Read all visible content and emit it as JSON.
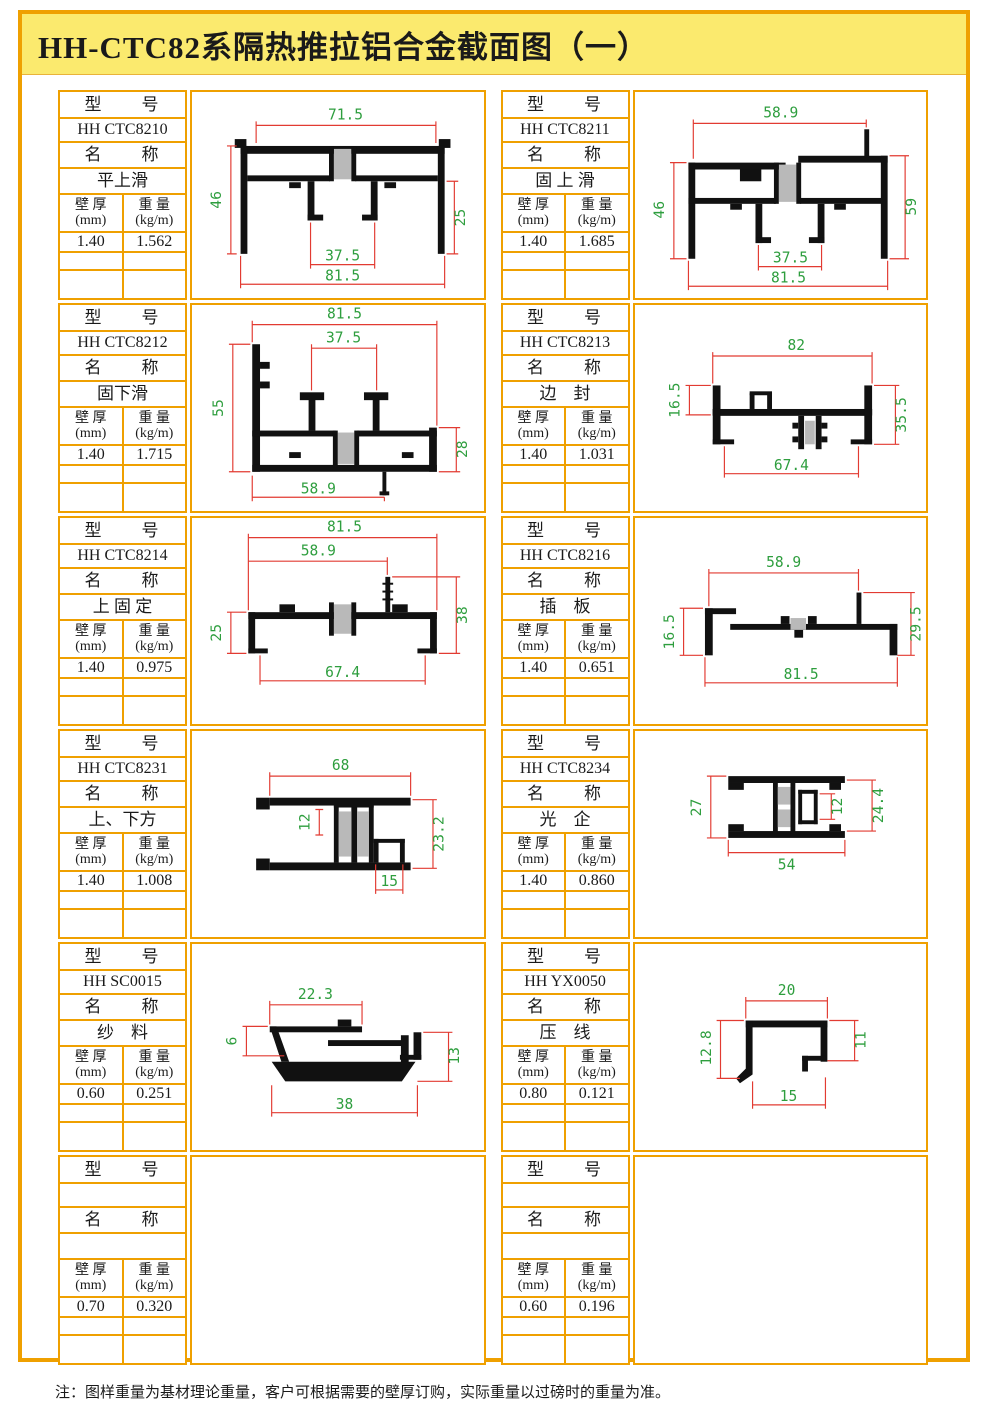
{
  "title": "HH-CTC82系隔热推拉铝合金截面图（一）",
  "note": "注：图样重量为基材理论重量，客户可根据需要的壁厚订购，实际重量以过磅时的重量为准。",
  "labels": {
    "model": "型　　号",
    "name": "名　　称",
    "thickness": "壁 厚\n(mm)",
    "weight": "重 量\n(kg/m)"
  },
  "colors": {
    "frame_border": "#efa000",
    "title_bg": "#fbea6e",
    "dim_line": "#e23b32",
    "dim_text": "#2e9e3e"
  },
  "cells": [
    {
      "model": "HH CTC8210",
      "name": "平上滑",
      "thickness": "1.40",
      "weight": "1.562",
      "dims": {
        "top": "71.5",
        "left": "46",
        "right": "25",
        "bottom1": "37.5",
        "bottom2": "81.5"
      }
    },
    {
      "model": "HH CTC8211",
      "name": "固 上 滑",
      "thickness": "1.40",
      "weight": "1.685",
      "dims": {
        "top": "58.9",
        "left": "46",
        "right": "59",
        "bottom1": "37.5",
        "bottom2": "81.5"
      }
    },
    {
      "model": "HH CTC8212",
      "name": "固下滑",
      "thickness": "1.40",
      "weight": "1.715",
      "dims": {
        "top": "81.5",
        "top2": "37.5",
        "left": "55",
        "right": "28",
        "bottom1": "58.9"
      }
    },
    {
      "model": "HH CTC8213",
      "name": "边　封",
      "thickness": "1.40",
      "weight": "1.031",
      "dims": {
        "top": "82",
        "left": "16.5",
        "right": "35.5",
        "bottom1": "67.4"
      }
    },
    {
      "model": "HH CTC8214",
      "name": "上 固 定",
      "thickness": "1.40",
      "weight": "0.975",
      "dims": {
        "top": "81.5",
        "top2": "58.9",
        "left": "25",
        "right": "38",
        "bottom1": "67.4"
      }
    },
    {
      "model": "HH CTC8216",
      "name": "插　板",
      "thickness": "1.40",
      "weight": "0.651",
      "dims": {
        "top": "58.9",
        "left": "16.5",
        "right": "29.5",
        "bottom1": "81.5"
      }
    },
    {
      "model": "HH CTC8231",
      "name": "上、下方",
      "thickness": "1.40",
      "weight": "1.008",
      "dims": {
        "top": "68",
        "mid": "12",
        "right": "23.2",
        "bottom1": "15"
      }
    },
    {
      "model": "HH CTC8234",
      "name": "光　企",
      "thickness": "1.40",
      "weight": "0.860",
      "dims": {
        "left": "27",
        "mid": "12",
        "right": "24.4",
        "bottom1": "54"
      }
    },
    {
      "model": "HH SC0015",
      "name": "纱　料",
      "thickness": "0.60",
      "weight": "0.251",
      "dims": {
        "top": "22.3",
        "left": "6",
        "right": "13",
        "bottom1": "38"
      }
    },
    {
      "model": "HH YX0050",
      "name": "压　线",
      "thickness": "0.80",
      "weight": "0.121",
      "dims": {
        "top": "20",
        "left": "12.8",
        "right": "11",
        "bottom1": "15"
      }
    },
    {
      "model": "",
      "name": "",
      "thickness": "0.70",
      "weight": "0.320",
      "dims": {}
    },
    {
      "model": "",
      "name": "",
      "thickness": "0.60",
      "weight": "0.196",
      "dims": {}
    }
  ]
}
